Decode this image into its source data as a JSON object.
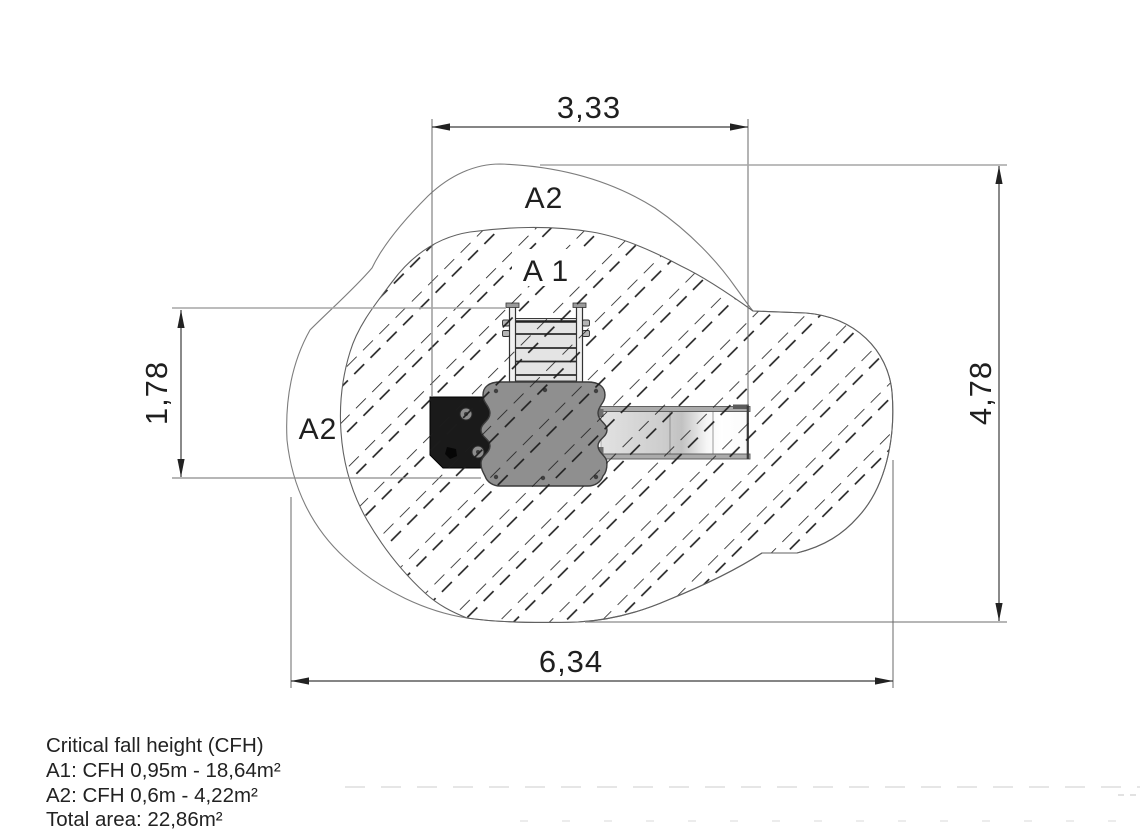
{
  "drawing": {
    "title_hint": "playground equipment safety-area plan (top view)",
    "zones": {
      "top": "A2",
      "middle": "A 1",
      "left": "A2"
    },
    "dims": {
      "top": "3,33",
      "left": "1,78",
      "right": "4,78",
      "bottom": "6,34"
    },
    "legend": {
      "title": "Critical fall height (CFH)",
      "line_a1": "A1: CFH 0,95m - 18,64m²",
      "line_a2": "A2: CFH 0,6m - 4,22m²",
      "line_total": "Total area: 22,86m²"
    },
    "colors": {
      "outline": "#7d7d7d",
      "inner_outline": "#606060",
      "hatch": "#1c1c1c",
      "dimension_line": "#3c3c3c",
      "extension_line": "#9a9a9a",
      "platform": "#8f8f8f",
      "climbing_panel": "#1a1a1a",
      "ladder_fill": "#e4e4e4",
      "slide_fill": "#e0e0e0",
      "text": "#1f1f1f"
    }
  }
}
